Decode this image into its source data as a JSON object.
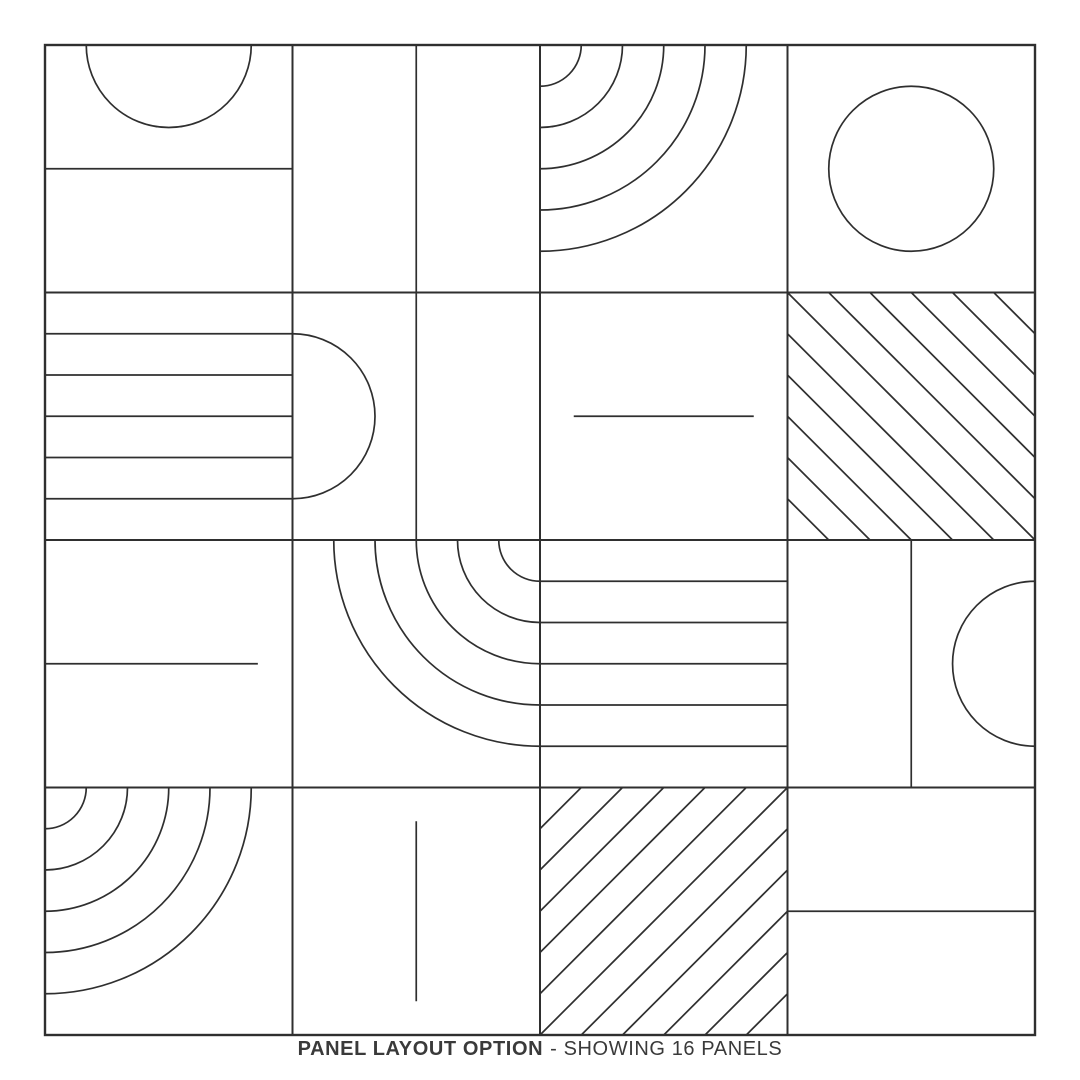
{
  "caption": {
    "title": "PANEL LAYOUT OPTION",
    "subtitle": "- SHOWING 16 PANELS"
  },
  "colors": {
    "background": "#ffffff",
    "line": "#2f2f2f",
    "caption": "#3a3a3a"
  },
  "grid": {
    "x": 45,
    "y": 45,
    "size": 990,
    "rows": 4,
    "cols": 4,
    "border_stroke": 2.4,
    "grid_stroke": 2,
    "shape_stroke": 1.7
  },
  "shapes": {
    "divisions": 6,
    "radius_units": 2,
    "arc_count": 5,
    "hatch_steps": 5,
    "short_line_length": 180,
    "partial_fraction": 0.86
  },
  "panels": [
    {
      "row": 0,
      "col": 0,
      "pattern": [
        "semicircle-top",
        "hline-full"
      ]
    },
    {
      "row": 0,
      "col": 1,
      "pattern": [
        "vline-full"
      ]
    },
    {
      "row": 0,
      "col": 2,
      "pattern": [
        "arcs-top-left"
      ]
    },
    {
      "row": 0,
      "col": 3,
      "pattern": [
        "circle-center"
      ]
    },
    {
      "row": 1,
      "col": 0,
      "pattern": [
        "stripes-h"
      ]
    },
    {
      "row": 1,
      "col": 1,
      "pattern": [
        "semicircle-left",
        "vline-full"
      ]
    },
    {
      "row": 1,
      "col": 2,
      "pattern": [
        "hline-short"
      ]
    },
    {
      "row": 1,
      "col": 3,
      "pattern": [
        "hatch-down"
      ]
    },
    {
      "row": 2,
      "col": 0,
      "pattern": [
        "hline-partial"
      ]
    },
    {
      "row": 2,
      "col": 1,
      "pattern": [
        "arcs-top-right"
      ]
    },
    {
      "row": 2,
      "col": 2,
      "pattern": [
        "stripes-h"
      ]
    },
    {
      "row": 2,
      "col": 3,
      "pattern": [
        "vline-full",
        "semicircle-right"
      ]
    },
    {
      "row": 3,
      "col": 0,
      "pattern": [
        "arcs-top-left"
      ]
    },
    {
      "row": 3,
      "col": 1,
      "pattern": [
        "vline-short"
      ]
    },
    {
      "row": 3,
      "col": 2,
      "pattern": [
        "hatch-up"
      ]
    },
    {
      "row": 3,
      "col": 3,
      "pattern": [
        "hline-full"
      ]
    }
  ]
}
